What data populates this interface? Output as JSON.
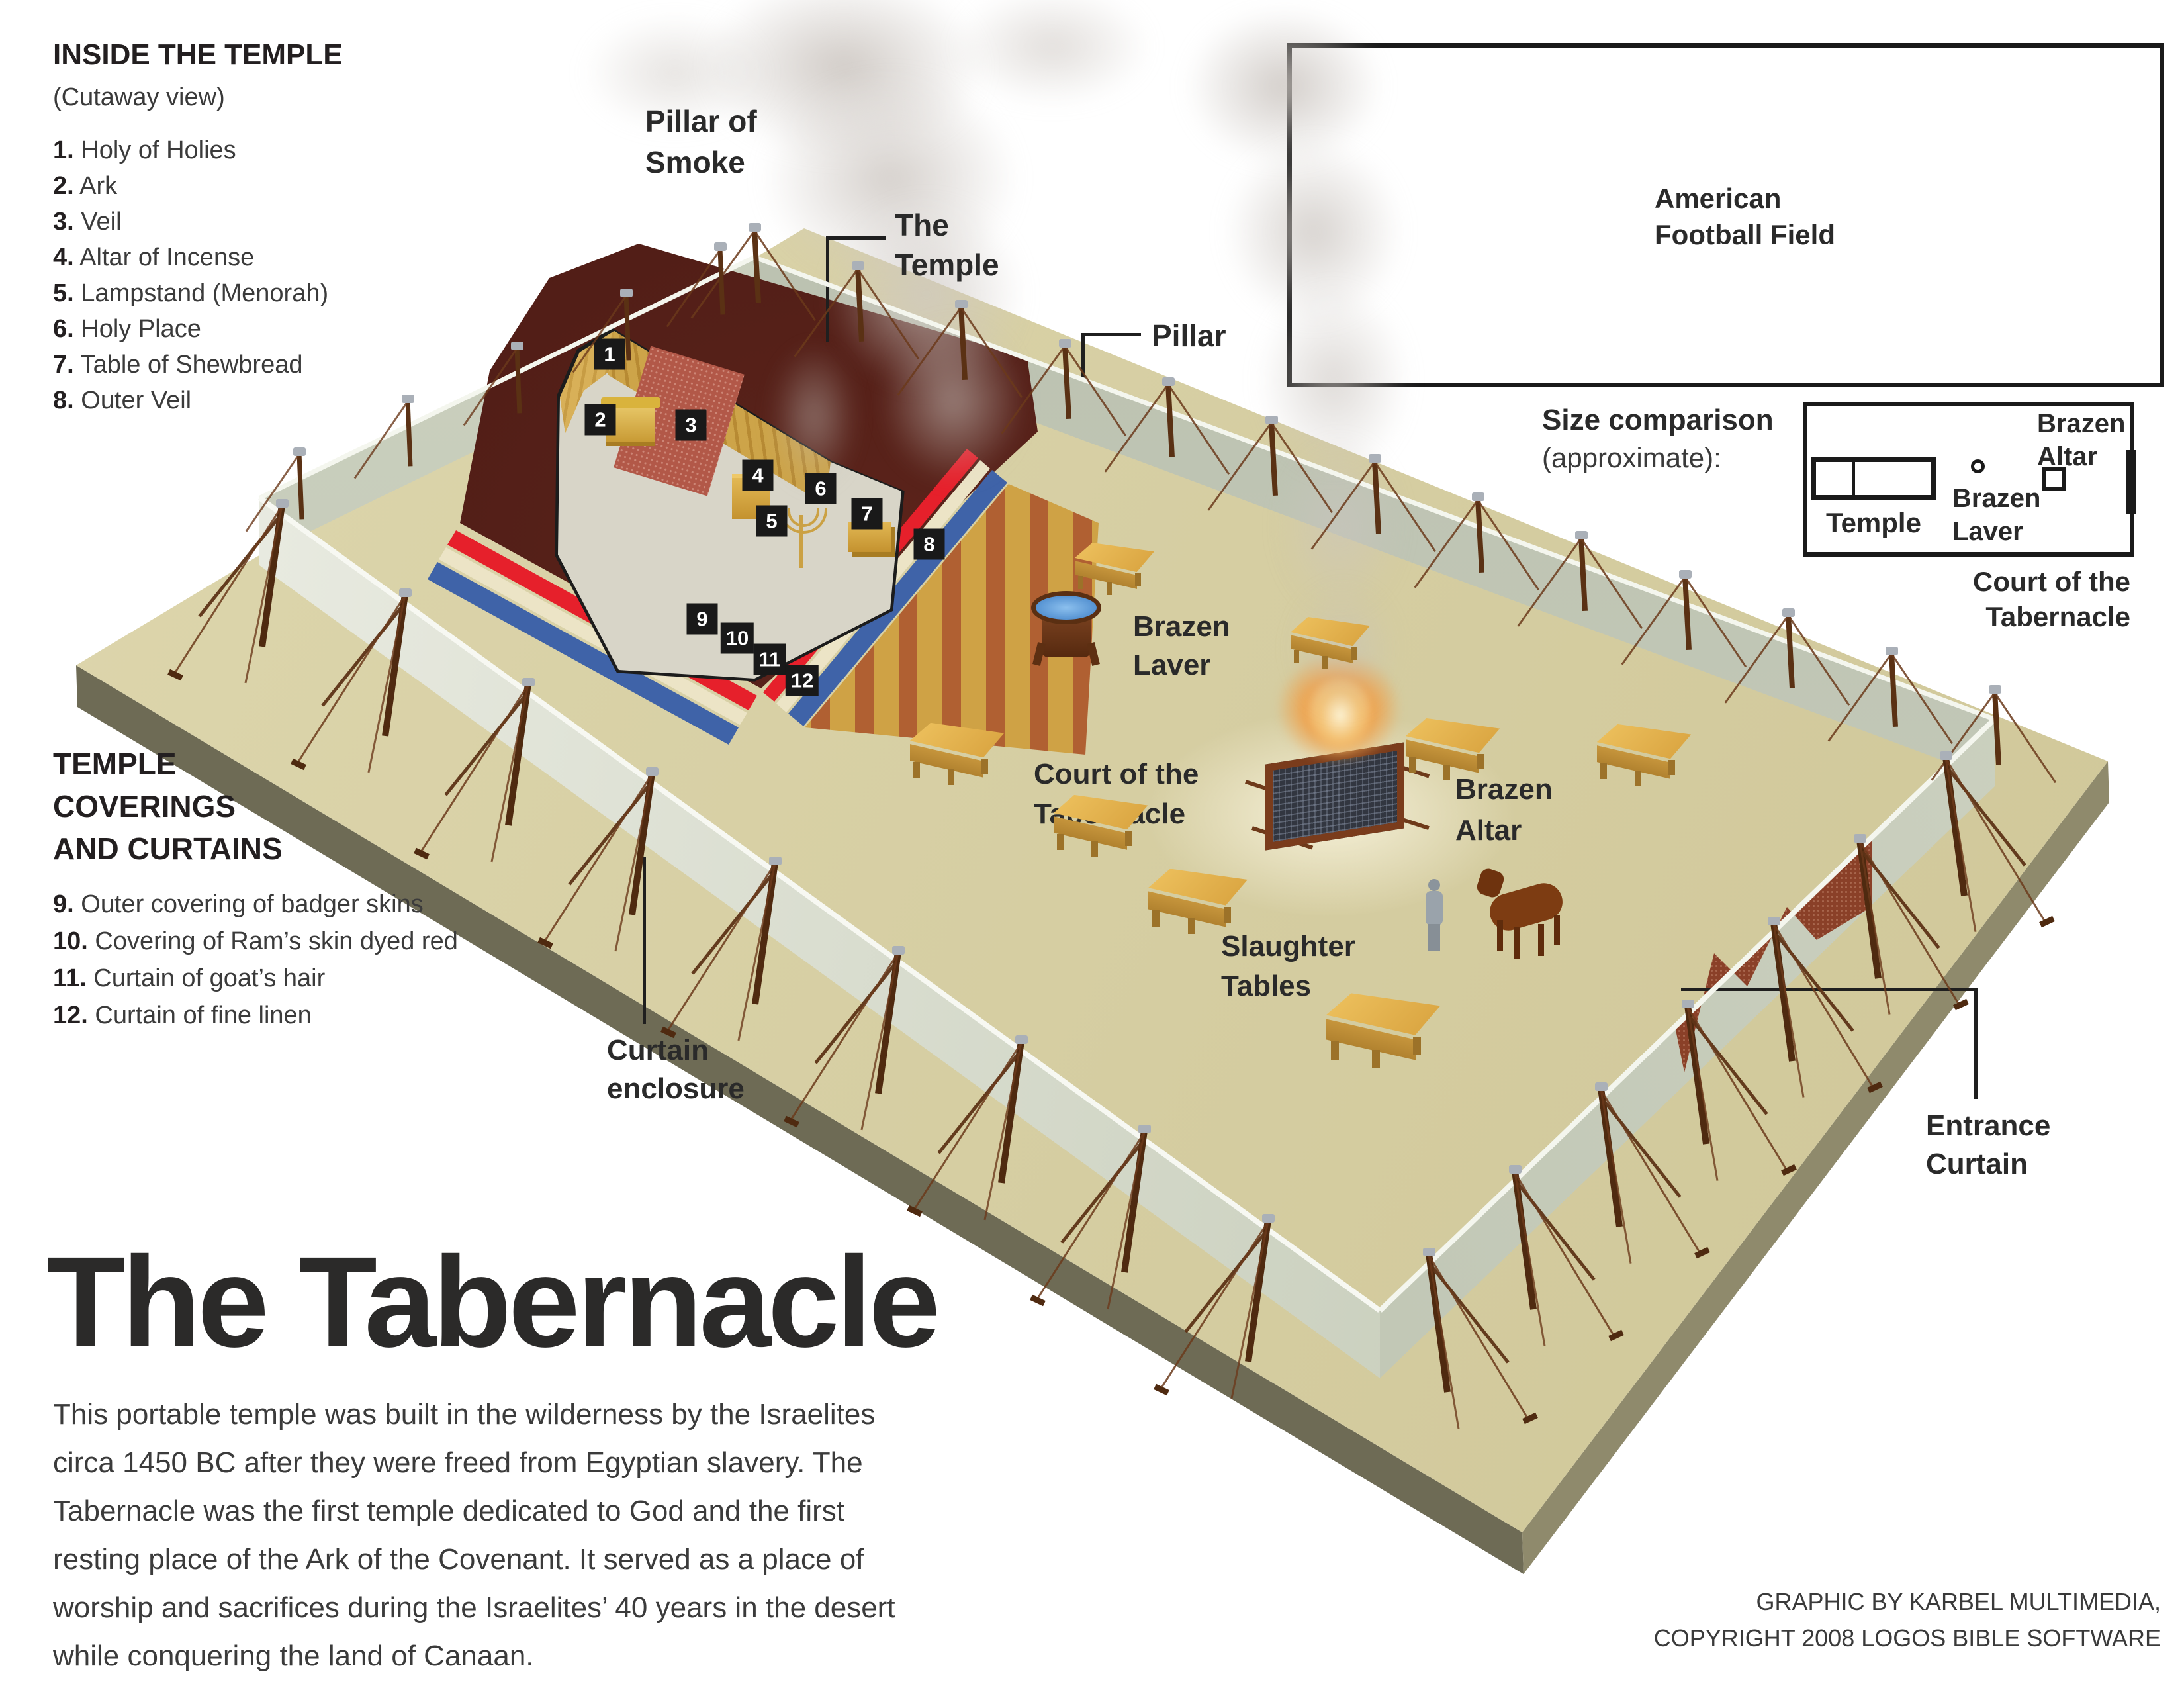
{
  "inside_the_temple": {
    "heading": "INSIDE THE TEMPLE",
    "subheading": "(Cutaway view)",
    "items": [
      {
        "num": "1.",
        "label": "Holy of Holies"
      },
      {
        "num": "2.",
        "label": "Ark"
      },
      {
        "num": "3.",
        "label": "Veil"
      },
      {
        "num": "4.",
        "label": "Altar of Incense"
      },
      {
        "num": "5.",
        "label": "Lampstand (Menorah)"
      },
      {
        "num": "6.",
        "label": "Holy Place"
      },
      {
        "num": "7.",
        "label": "Table of Shewbread"
      },
      {
        "num": "8.",
        "label": "Outer Veil"
      }
    ]
  },
  "coverings": {
    "heading_lines": [
      "TEMPLE",
      "COVERINGS",
      "AND CURTAINS"
    ],
    "items": [
      {
        "num": "9.",
        "label": "Outer covering of badger skins"
      },
      {
        "num": "10.",
        "label": "Covering of Ram’s skin dyed red"
      },
      {
        "num": "11.",
        "label": "Curtain of goat’s hair"
      },
      {
        "num": "12.",
        "label": "Curtain of fine linen"
      }
    ]
  },
  "title_block": {
    "title": "The Tabernacle",
    "paragraph_lines": [
      "This portable temple was built in the wilderness by the Israelites",
      "circa 1450 BC after they were freed from Egyptian slavery. The",
      "Tabernacle was the first temple dedicated to God and the first",
      "resting place of the Ark of the Covenant. It served as a place of",
      "worship and sacrifices during the Israelites’ 40 years in the desert",
      "while conquering the land of Canaan."
    ]
  },
  "credit_lines": [
    "GRAPHIC BY KARBEL MULTIMEDIA,",
    "COPYRIGHT 2008 LOGOS BIBLE SOFTWARE"
  ],
  "football_field": {
    "label_lines": [
      "American",
      "Football Field"
    ]
  },
  "size_comparison": {
    "heading": "Size comparison",
    "subheading": "(approximate):",
    "temple_label": "Temple",
    "brazen_laver_lines": [
      "Brazen",
      "Laver"
    ],
    "brazen_altar_lines": [
      "Brazen",
      "Altar"
    ],
    "court_lines": [
      "Court of the",
      "Tabernacle"
    ]
  },
  "scene_labels": {
    "pillar_of_smoke_lines": [
      "Pillar of",
      "Smoke"
    ],
    "the_temple_lines": [
      "The",
      "Temple"
    ],
    "pillar": "Pillar",
    "brazen_laver_lines": [
      "Brazen",
      "Laver"
    ],
    "court_lines": [
      "Court of the",
      "Tabernacle"
    ],
    "brazen_altar_lines": [
      "Brazen",
      "Altar"
    ],
    "slaughter_tables_lines": [
      "Slaughter",
      "Tables"
    ],
    "curtain_enclosure_lines": [
      "Curtain",
      "enclosure"
    ],
    "entrance_curtain_lines": [
      "Entrance",
      "Curtain"
    ]
  },
  "badges": [
    "1",
    "2",
    "3",
    "4",
    "5",
    "6",
    "7",
    "8",
    "9",
    "10",
    "11",
    "12"
  ],
  "colors": {
    "ground_tan": "#d9d2a8",
    "platform_side_dark": "#6e6b55",
    "curtain_sage": "#c6cbb8",
    "curtain_white": "#eceee4",
    "tent_maroon": "#4a1a13",
    "covering_red": "#e6202b",
    "covering_cream": "#ece4c6",
    "covering_blue": "#3f63a8",
    "gold": "#cfa245",
    "fire_orange": "#e89040",
    "water_blue": "#4a8fd8",
    "text_dark": "#231f20"
  }
}
